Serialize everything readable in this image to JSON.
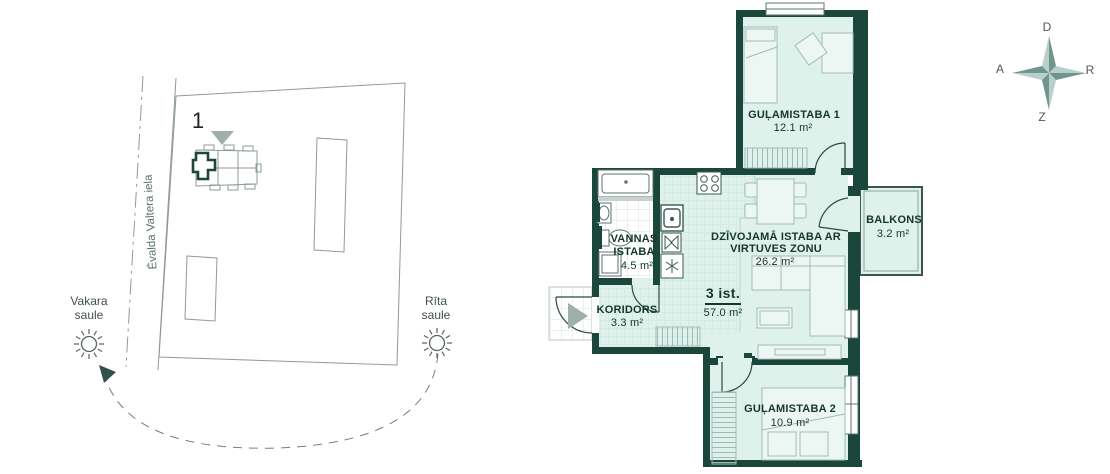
{
  "site_plan": {
    "street_name": "Ēvalda Valtera iela",
    "building_number": "1",
    "evening_sun": {
      "line1": "Vakara",
      "line2": "saule"
    },
    "morning_sun": {
      "line1": "Rīta",
      "line2": "saule"
    }
  },
  "compass": {
    "top": "D",
    "left": "A",
    "right": "R",
    "bottom": "Z"
  },
  "apartment": {
    "total": {
      "rooms_label": "3 ist.",
      "area": "57.0 m²"
    },
    "rooms": {
      "bedroom1": {
        "name": "GUĻAMISTABA 1",
        "area": "12.1 m²"
      },
      "living": {
        "name_line1": "DZĪVOJAMĀ ISTABA AR",
        "name_line2": "VIRTUVES ZONU",
        "area": "26.2 m²"
      },
      "bathroom": {
        "name_line1": "VANNAS",
        "name_line2": "ISTABA",
        "area": "4.5 m²"
      },
      "corridor": {
        "name": "KORIDORS",
        "area": "3.3 m²"
      },
      "balcony": {
        "name": "BALKONS",
        "area": "3.2 m²"
      },
      "bedroom2": {
        "name": "GUĻAMISTABA 2",
        "area": "10.9 m²"
      }
    }
  },
  "colors": {
    "wall": "#1b463c",
    "floor": "#def1eb",
    "compass_light": "#b9d0ca",
    "compass_dark": "#6f968c",
    "site_line": "#8e9b97"
  }
}
